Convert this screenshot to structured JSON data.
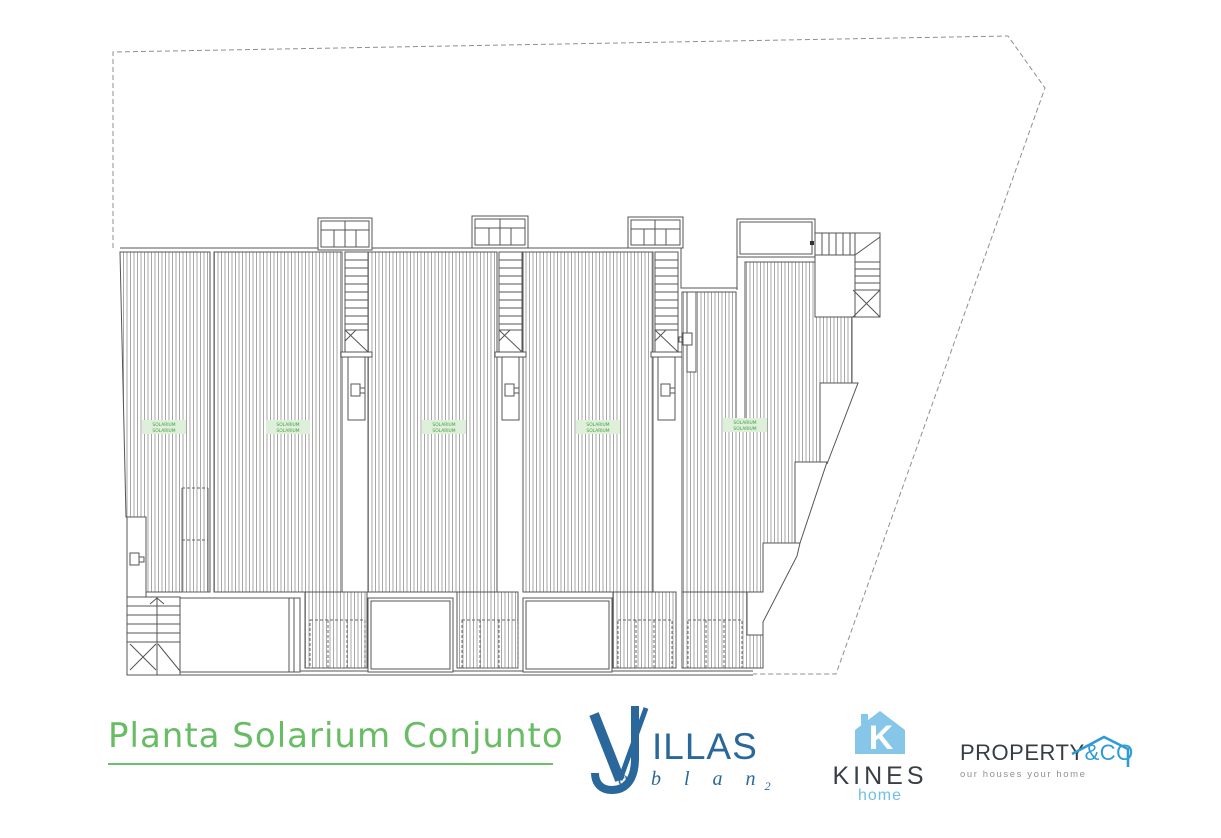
{
  "plan": {
    "labels": [
      "SOLARIUM",
      "SOLARIUM",
      "SOLARIUM",
      "SOLARIUM",
      "SOLARIUM"
    ],
    "label_color": "#3f9e3f",
    "label_bg": "#dff0da",
    "line_color": "#555555",
    "boundary_style": "dashed"
  },
  "footer": {
    "title": "Planta Solarium Conjunto",
    "title_color": "#68bc64",
    "logos": {
      "villas_joblan": {
        "name_top": "ILLAS",
        "name_bottom": "o b l a n",
        "subscript": "2",
        "color": "#2a689b"
      },
      "kines": {
        "name": "KINES",
        "sub": "home",
        "monogram": "K",
        "icon_color": "#85c6e9",
        "text_color": "#3a3f45"
      },
      "property_co": {
        "name_main": "PROPERTY",
        "name_accent": "&CO",
        "tagline": "our houses your home",
        "accent_color": "#2e9bd6"
      }
    }
  }
}
